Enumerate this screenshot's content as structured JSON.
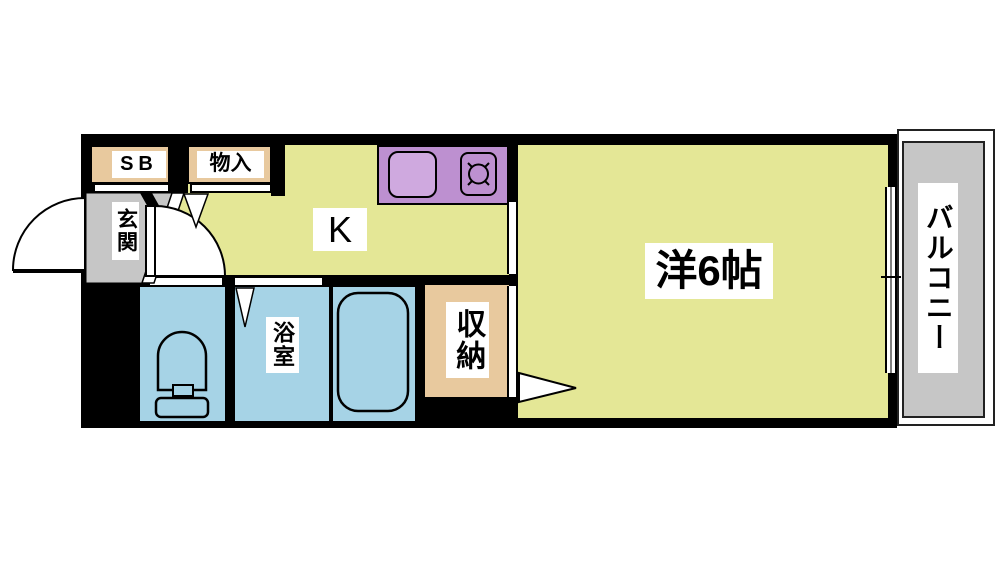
{
  "floorplan": {
    "labels": {
      "shoe_box": "SB",
      "storage_top": "物入",
      "entrance": "玄関",
      "kitchen": "K",
      "western_room": "洋6帖",
      "bathroom": "浴室",
      "closet": "収納",
      "balcony": "バルコニー"
    },
    "colors": {
      "room_yellow": "#e4e796",
      "storage_tan": "#e8c99e",
      "entrance_gray": "#c6c6c6",
      "balcony_gray": "#c6c6c6",
      "wet_area_blue": "#a6d3e6",
      "counter_purple": "#bd90d0",
      "sink_purple": "#cfa9df",
      "wall_black": "#000000",
      "label_background": "#ffffff",
      "label_text": "#000000"
    },
    "icons": [
      "entrance-door-swing-icon",
      "interior-door-swing-icon",
      "folding-door-triangle-icon",
      "closet-door-triangle-icon",
      "toilet-icon",
      "bathtub-icon",
      "kitchen-sink-icon",
      "stove-burner-icon",
      "sliding-window-icon"
    ]
  }
}
